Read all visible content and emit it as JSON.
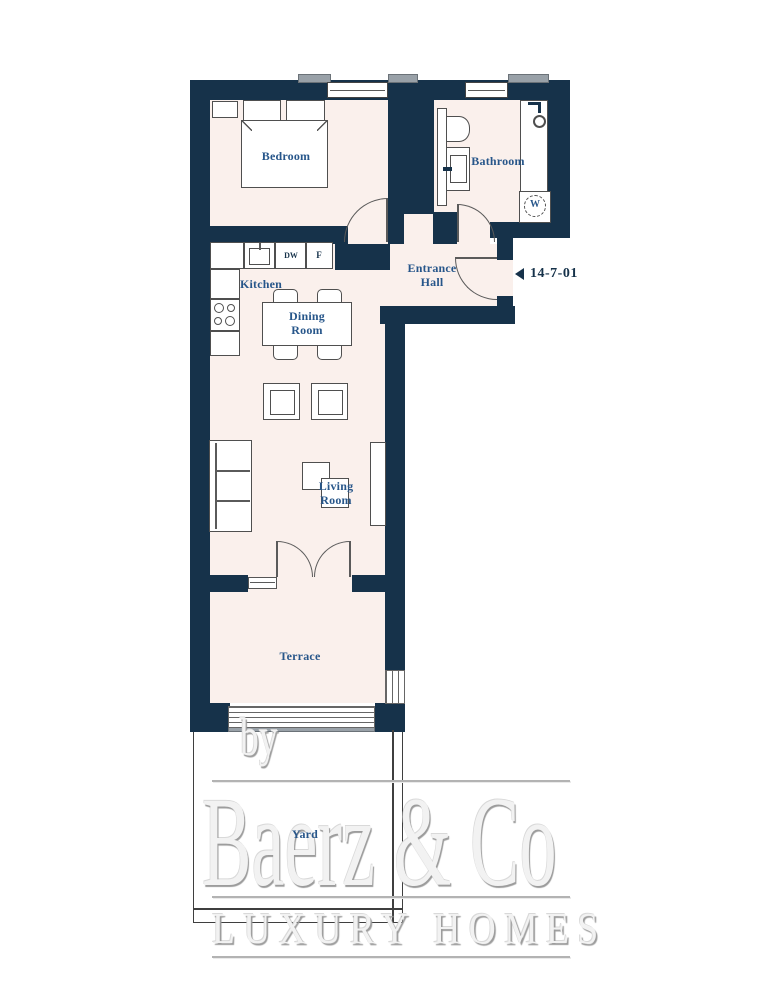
{
  "rooms": {
    "bedroom": "Bedroom",
    "bathroom": "Bathroom",
    "kitchen": "Kitchen",
    "dining_room": "Dining Room",
    "entrance_hall": "Entrance Hall",
    "living_room": "Living Room",
    "terrace": "Terrace",
    "yard": "Yard"
  },
  "appliances": {
    "dishwasher": "DW",
    "fridge": "F",
    "washer": "W"
  },
  "unit": {
    "number": "14-7-01"
  },
  "watermark": {
    "by": "by",
    "brand": "Baerz & Co",
    "tagline": "LUXURY HOMES"
  },
  "colors": {
    "wall": "#16324a",
    "floor": "#faf0ec",
    "label": "#27568a",
    "furn": "#4f4f4f"
  }
}
